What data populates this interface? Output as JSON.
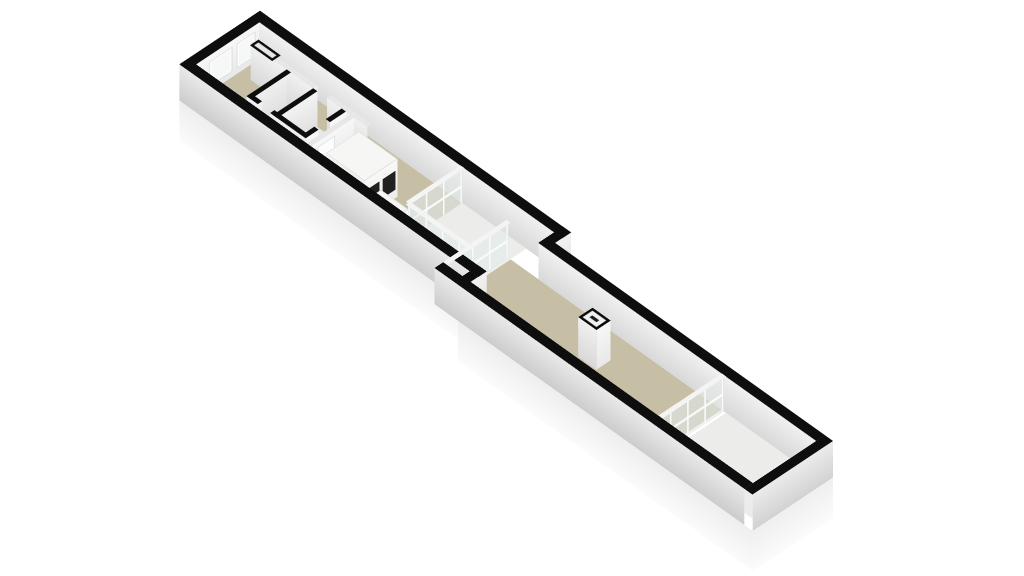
{
  "page": {
    "background": "#ffffff"
  },
  "palette": {
    "wall_cut_outline": "#0e0e0e",
    "floor_main": "#c7bea6",
    "floor_light": "#ecedeb",
    "wall_face_light": "#f2f2f2",
    "wall_face_shade": "#d8d8d8",
    "plinth": "#fbfbfb",
    "glass": "#dee7e4",
    "glass_frame": "#f3f4f3",
    "void_frame": "#b3b3ac",
    "appliance_front": "#212121"
  },
  "scene": {
    "name": "3d-floorplan-long-narrow-building",
    "wall_height": 50,
    "elements": [
      {
        "n": "slab-side-west",
        "t": "fy",
        "x": 0,
        "y": 0,
        "L": 112,
        "hz": 55,
        "z": -55,
        "cls": "slab-fy"
      },
      {
        "n": "slab-side-a-south",
        "t": "fx",
        "x": 0,
        "y": 112,
        "w": 424,
        "hz": 55,
        "z": -55,
        "cls": "slab-fx"
      },
      {
        "n": "slab-step",
        "t": "fy",
        "x": 424,
        "y": 112,
        "L": 22,
        "hz": 55,
        "z": -55,
        "cls": "slab-fy"
      },
      {
        "n": "slab-side-b-south",
        "t": "fx",
        "x": 424,
        "y": 134,
        "w": 424,
        "hz": 55,
        "z": -55,
        "cls": "slab-fx"
      },
      {
        "n": "slab-side-east",
        "t": "fy",
        "x": 848,
        "y": 22,
        "L": 112,
        "hz": 55,
        "z": -55,
        "cls": "slab-fy"
      },
      {
        "n": "floor-room-a",
        "t": "top",
        "x": 12,
        "y": 12,
        "w": 292,
        "h": 88,
        "z": 0,
        "cls": "beige"
      },
      {
        "n": "floor-courtyard",
        "t": "top",
        "x": 304,
        "y": 12,
        "w": 92,
        "h": 76,
        "z": 0.3,
        "cls": "white-floor"
      },
      {
        "n": "floor-corridor-strip",
        "t": "top",
        "x": 304,
        "y": 88,
        "w": 132,
        "h": 12,
        "z": 0.3,
        "cls": "beige"
      },
      {
        "n": "floor-room-b",
        "t": "top",
        "x": 396,
        "y": 34,
        "w": 304,
        "h": 88,
        "z": 0,
        "cls": "beige"
      },
      {
        "n": "floor-end-room",
        "t": "top",
        "x": 706,
        "y": 34,
        "w": 130,
        "h": 88,
        "z": 0,
        "cls": "white-floor"
      },
      {
        "n": "floor-bathroom",
        "t": "top",
        "x": 86,
        "y": 40,
        "w": 73,
        "h": 50,
        "z": 0.6,
        "cls": "wc-floor"
      },
      {
        "n": "floor-void-1",
        "t": "top",
        "x": 400,
        "y": 96,
        "w": 100,
        "h": 22,
        "z": 0.9,
        "cls": "void"
      },
      {
        "n": "floor-void-2",
        "t": "top",
        "x": 512,
        "y": 96,
        "w": 86,
        "h": 22,
        "z": 0.9,
        "cls": "void"
      },
      {
        "n": "floor-void-3",
        "t": "top",
        "x": 612,
        "y": 96,
        "w": 78,
        "h": 22,
        "z": 0.9,
        "cls": "void"
      },
      {
        "n": "wall-top-a-north",
        "t": "top",
        "x": 0,
        "y": 0,
        "w": 448,
        "h": 12,
        "z": 50,
        "cls": "black"
      },
      {
        "n": "wall-face-a-north-int",
        "t": "fx",
        "x": 12,
        "y": 12,
        "w": 436,
        "hz": 50,
        "z": 0,
        "cls": "int-fx"
      },
      {
        "n": "wall-top-a-west",
        "t": "top",
        "x": 0,
        "y": 0,
        "w": 12,
        "h": 112,
        "z": 50.1,
        "cls": "black"
      },
      {
        "n": "wall-face-a-west-int",
        "t": "fy",
        "x": 12,
        "y": 12,
        "L": 88,
        "hz": 50,
        "z": 0,
        "cls": "int-fy-bright"
      },
      {
        "n": "wall-face-a-west-ext",
        "t": "fy",
        "x": 0,
        "y": 0,
        "L": 112,
        "hz": 50,
        "z": 0,
        "cls": "ext-fy"
      },
      {
        "n": "window-1-int",
        "t": "fy",
        "x": 12.8,
        "y": 20,
        "L": 24,
        "hz": 32,
        "z": 10,
        "cls": "win"
      },
      {
        "n": "window-2-int",
        "t": "fy",
        "x": 12.8,
        "y": 52,
        "L": 30,
        "hz": 32,
        "z": 10,
        "cls": "win"
      },
      {
        "n": "window-1-ext",
        "t": "fy",
        "x": -0.8,
        "y": 20,
        "L": 24,
        "hz": 32,
        "z": 10,
        "cls": "win"
      },
      {
        "n": "window-2-ext",
        "t": "fy",
        "x": -0.8,
        "y": 52,
        "L": 30,
        "hz": 32,
        "z": 10,
        "cls": "win"
      },
      {
        "n": "wall-top-a-south",
        "t": "top",
        "x": 0,
        "y": 100,
        "w": 430,
        "h": 12,
        "z": 50,
        "cls": "black"
      },
      {
        "n": "wall-face-a-south-ext",
        "t": "fx",
        "x": 0,
        "y": 112,
        "w": 430,
        "hz": 50,
        "z": 0,
        "cls": "ext-fx"
      },
      {
        "n": "wall-top-junction-north",
        "t": "top",
        "x": 436,
        "y": 0,
        "w": 12,
        "h": 34,
        "z": 50.2,
        "cls": "black"
      },
      {
        "n": "wall-face-junction-north",
        "t": "fy",
        "x": 448,
        "y": 0,
        "L": 34,
        "hz": 50,
        "z": 0,
        "cls": "int-fy"
      },
      {
        "n": "wall-top-junction-south",
        "t": "top",
        "x": 418,
        "y": 100,
        "w": 12,
        "h": 34,
        "z": 50.2,
        "cls": "black"
      },
      {
        "n": "wall-face-junction-south",
        "t": "fy",
        "x": 430,
        "y": 100,
        "L": 22,
        "hz": 50,
        "z": 0,
        "cls": "int-fy"
      },
      {
        "n": "wall-top-b-north",
        "t": "top",
        "x": 436,
        "y": 22,
        "w": 400,
        "h": 12,
        "z": 50,
        "cls": "black"
      },
      {
        "n": "wall-face-b-north-int",
        "t": "fx",
        "x": 436,
        "y": 34,
        "w": 400,
        "hz": 50,
        "z": 0,
        "cls": "int-fx"
      },
      {
        "n": "wall-top-b-south",
        "t": "top",
        "x": 390,
        "y": 122,
        "w": 446,
        "h": 12,
        "z": 50,
        "cls": "black"
      },
      {
        "n": "wall-face-b-south-ext",
        "t": "fx",
        "x": 390,
        "y": 134,
        "w": 446,
        "hz": 50,
        "z": 0,
        "cls": "ext-fx"
      },
      {
        "n": "wall-top-b-east",
        "t": "top",
        "x": 836,
        "y": 22,
        "w": 12,
        "h": 112,
        "z": 50.1,
        "cls": "black"
      },
      {
        "n": "wall-face-b-east-int",
        "t": "fy",
        "x": 836,
        "y": 34,
        "L": 88,
        "hz": 50,
        "z": 0,
        "cls": "int-fy-bright"
      },
      {
        "n": "wall-face-b-east-ext",
        "t": "fy",
        "x": 848,
        "y": 22,
        "L": 112,
        "hz": 50,
        "z": 0,
        "cls": "ext-fy"
      },
      {
        "n": "wall-top-hall-1",
        "t": "top",
        "x": 28,
        "y": 34,
        "w": 90,
        "h": 6,
        "z": 50,
        "cls": "white-top"
      },
      {
        "n": "wall-top-hall-2",
        "t": "top",
        "x": 138,
        "y": 34,
        "w": 58,
        "h": 6,
        "z": 50,
        "cls": "white-top"
      },
      {
        "n": "wall-face-hall-1",
        "t": "fx",
        "x": 28,
        "y": 40,
        "w": 90,
        "hz": 50,
        "z": 0,
        "cls": "int-fx"
      },
      {
        "n": "wall-face-hall-2",
        "t": "fx",
        "x": 138,
        "y": 40,
        "w": 58,
        "hz": 50,
        "z": 0,
        "cls": "int-fx"
      },
      {
        "n": "door-jamb-1",
        "t": "fy",
        "x": 118,
        "y": 34,
        "L": 6,
        "hz": 50,
        "z": 0,
        "cls": "int-fy"
      },
      {
        "n": "door-jamb-2",
        "t": "fy",
        "x": 138,
        "y": 34,
        "L": 6,
        "hz": 50,
        "z": 0,
        "cls": "int-fy"
      },
      {
        "n": "door-frame-mark",
        "t": "top",
        "x": 30,
        "y": 31,
        "w": 32,
        "h": 12,
        "z": 51.2,
        "cls": "door-mark"
      },
      {
        "n": "wall-top-wc-west",
        "t": "top",
        "x": 80,
        "y": 40,
        "w": 6,
        "h": 56,
        "z": 50.1,
        "cls": "black"
      },
      {
        "n": "wall-top-wc-mid",
        "t": "top",
        "x": 118,
        "y": 40,
        "w": 6,
        "h": 56,
        "z": 50.1,
        "cls": "black"
      },
      {
        "n": "wall-top-wc-east-1",
        "t": "top",
        "x": 159,
        "y": 40,
        "w": 6,
        "h": 22,
        "z": 50.1,
        "cls": "black"
      },
      {
        "n": "wall-top-wc-east-2",
        "t": "top",
        "x": 159,
        "y": 78,
        "w": 6,
        "h": 18,
        "z": 50.1,
        "cls": "black"
      },
      {
        "n": "wall-top-wc-south-1",
        "t": "top",
        "x": 80,
        "y": 90,
        "w": 16,
        "h": 6,
        "z": 50.1,
        "cls": "black"
      },
      {
        "n": "wall-top-wc-south-2",
        "t": "top",
        "x": 114,
        "y": 90,
        "w": 51,
        "h": 6,
        "z": 50.1,
        "cls": "black"
      },
      {
        "n": "wall-face-wc-south-1",
        "t": "fx",
        "x": 80,
        "y": 96,
        "w": 16,
        "hz": 50,
        "z": 0,
        "cls": "int-fx"
      },
      {
        "n": "wall-face-wc-south-2",
        "t": "fx",
        "x": 114,
        "y": 96,
        "w": 51,
        "hz": 50,
        "z": 0,
        "cls": "int-fx"
      },
      {
        "n": "wall-face-wc-east-1",
        "t": "fy",
        "x": 165,
        "y": 40,
        "L": 22,
        "hz": 50,
        "z": 0,
        "cls": "int-fy-bright"
      },
      {
        "n": "wall-face-wc-east-2",
        "t": "fy",
        "x": 165,
        "y": 78,
        "L": 18,
        "hz": 50,
        "z": 0,
        "cls": "int-fy-bright"
      },
      {
        "n": "wall-face-wc-divider",
        "t": "fy",
        "x": 124,
        "y": 40,
        "L": 50,
        "hz": 50,
        "z": 0,
        "cls": "int-fy"
      },
      {
        "n": "wall-face-wc-west",
        "t": "fy",
        "x": 80,
        "y": 40,
        "L": 56,
        "hz": 50,
        "z": 0,
        "cls": "int-fy"
      },
      {
        "n": "door-jamb-wc-1",
        "t": "fy",
        "x": 96,
        "y": 90,
        "L": 6,
        "hz": 50,
        "z": 0,
        "cls": "int-fy"
      },
      {
        "n": "door-jamb-wc-2",
        "t": "fy",
        "x": 114,
        "y": 90,
        "L": 6,
        "hz": 50,
        "z": 0,
        "cls": "int-fy"
      },
      {
        "n": "wall-top-partition",
        "t": "top",
        "x": 171,
        "y": 40,
        "w": 6,
        "h": 60,
        "z": 50,
        "cls": "white-top"
      },
      {
        "n": "wall-face-partition-e",
        "t": "fy",
        "x": 177,
        "y": 40,
        "L": 60,
        "hz": 50,
        "z": 0,
        "cls": "int-fy-bright"
      },
      {
        "n": "wall-face-partition-w",
        "t": "fy",
        "x": 171,
        "y": 40,
        "L": 60,
        "hz": 50,
        "z": 0,
        "cls": "int-fy"
      },
      {
        "n": "door-leaf",
        "t": "fy",
        "x": 177.8,
        "y": 68,
        "L": 24,
        "hz": 42,
        "z": 2,
        "cls": "door-leaf"
      },
      {
        "n": "door-handle",
        "t": "fy",
        "x": 178.6,
        "y": 70,
        "L": 2,
        "hz": 4,
        "z": 22,
        "cls": "handle"
      },
      {
        "n": "cabinet-top",
        "t": "top",
        "x": 196,
        "y": 52,
        "w": 56,
        "h": 46,
        "z": 52,
        "cls": "cab-top"
      },
      {
        "n": "cabinet-front",
        "t": "fy",
        "x": 252,
        "y": 52,
        "L": 46,
        "hz": 52,
        "z": 0,
        "cls": "cab-face"
      },
      {
        "n": "cabinet-side",
        "t": "fx",
        "x": 196,
        "y": 98,
        "w": 56,
        "hz": 52,
        "z": 0,
        "cls": "cab-side"
      },
      {
        "n": "cabinet-panel-1",
        "t": "fy",
        "x": 252.8,
        "y": 56,
        "L": 18,
        "hz": 26,
        "z": 13,
        "cls": "dark"
      },
      {
        "n": "cabinet-panel-2",
        "t": "fy",
        "x": 252.8,
        "y": 78,
        "L": 18,
        "hz": 26,
        "z": 13,
        "cls": "dark"
      },
      {
        "n": "counter-top",
        "t": "top",
        "x": 252,
        "y": 76,
        "w": 40,
        "h": 22,
        "z": 26,
        "cls": "cab-top"
      },
      {
        "n": "counter-front",
        "t": "fy",
        "x": 292,
        "y": 76,
        "L": 22,
        "hz": 26,
        "z": 0,
        "cls": "cab-face"
      },
      {
        "n": "counter-side",
        "t": "fx",
        "x": 252,
        "y": 98,
        "w": 40,
        "hz": 26,
        "z": 0,
        "cls": "cab-side"
      },
      {
        "n": "chimney-face-e",
        "t": "fy",
        "x": 571,
        "y": 64,
        "L": 20,
        "hz": 55,
        "z": 0,
        "cls": "int-fy-bright"
      },
      {
        "n": "chimney-face-s",
        "t": "fx",
        "x": 545,
        "y": 84,
        "w": 26,
        "hz": 55,
        "z": 0,
        "cls": "int-fx"
      },
      {
        "n": "chimney-top",
        "t": "top",
        "x": 545,
        "y": 64,
        "w": 26,
        "h": 20,
        "z": 55,
        "cls": "chimney-top"
      },
      {
        "n": "glass-wall-courtyard-west",
        "t": "fy",
        "x": 304,
        "y": 12,
        "L": 76,
        "hz": 50,
        "z": 0,
        "cls": "glass-y"
      },
      {
        "n": "glass-top-courtyard-west",
        "t": "top",
        "x": 301,
        "y": 12,
        "w": 6,
        "h": 76,
        "z": 50.4,
        "cls": "glass-top"
      },
      {
        "n": "glass-wall-courtyard-south",
        "t": "fx",
        "x": 304,
        "y": 88,
        "w": 92,
        "hz": 50,
        "z": 0,
        "cls": "glass-x"
      },
      {
        "n": "glass-top-courtyard-south",
        "t": "top",
        "x": 304,
        "y": 85,
        "w": 92,
        "h": 6,
        "z": 50.4,
        "cls": "glass-top"
      },
      {
        "n": "glass-wall-b-west",
        "t": "fy",
        "x": 393,
        "y": 34,
        "L": 88,
        "hz": 50,
        "z": 0,
        "cls": "glass-y"
      },
      {
        "n": "glass-top-b-west",
        "t": "top",
        "x": 390,
        "y": 34,
        "w": 6,
        "h": 88,
        "z": 50.4,
        "cls": "glass-top"
      },
      {
        "n": "glass-partition",
        "t": "fy",
        "x": 703,
        "y": 34,
        "L": 88,
        "hz": 50,
        "z": 0,
        "cls": "glass-y"
      },
      {
        "n": "glass-partition-top",
        "t": "top",
        "x": 700,
        "y": 34,
        "w": 6,
        "h": 88,
        "z": 50.4,
        "cls": "glass-top"
      }
    ]
  }
}
